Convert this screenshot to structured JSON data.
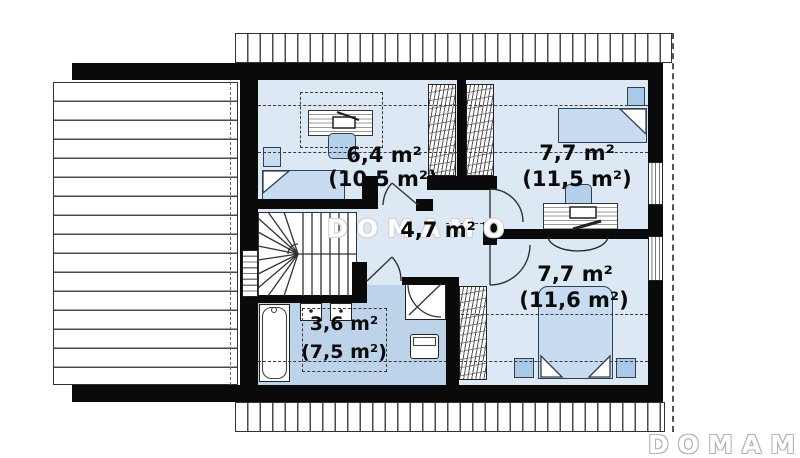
{
  "plan": {
    "type": "attic-floor-plan",
    "watermark_center": "DOMAMO",
    "brand_logo": "DOMAMO",
    "rooms": [
      {
        "name": "bedroom-upper-left",
        "usable_area": "6,4 m²",
        "total_area": "(10,5 m²)"
      },
      {
        "name": "bedroom-upper-right",
        "usable_area": "7,7 m²",
        "total_area": "(11,5 m²)"
      },
      {
        "name": "hall",
        "usable_area": "4,7 m²"
      },
      {
        "name": "bedroom-lower-right",
        "usable_area": "7,7 m²",
        "total_area": "(11,6 m²)"
      },
      {
        "name": "bathroom",
        "usable_area": "3,6 m²",
        "total_area": "(7,5 m²)"
      }
    ],
    "colors": {
      "wall": "#0a0a0a",
      "floor": "#dce8f4",
      "bathroom_floor": "#bdd3e9",
      "furniture": "#c7dcf0",
      "accent": "#a9c9e6",
      "watermark": "#b3b3b3"
    }
  }
}
